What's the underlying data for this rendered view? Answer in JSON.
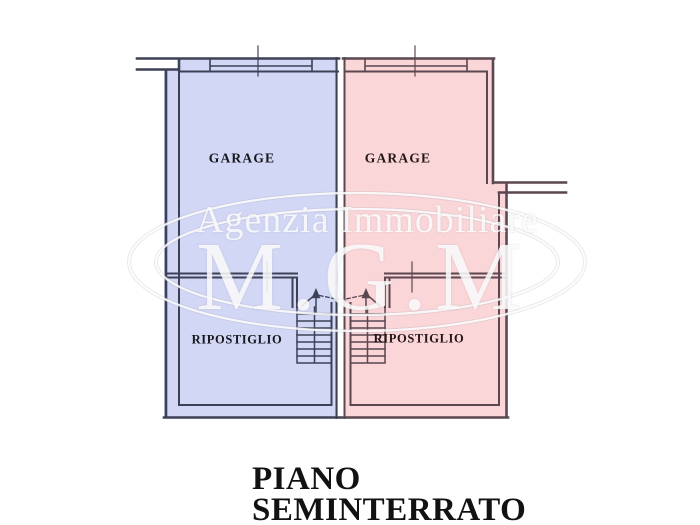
{
  "floor_title": {
    "lines": [
      "PIANO",
      "SEMINTERRATO"
    ]
  },
  "watermark": {
    "agency_line": "Agenzia Immobiliare",
    "logo_text": "M.G.M"
  },
  "units": {
    "left": {
      "garage_label": "GARAGE",
      "storage_label": "RIPOSTIGLIO",
      "fill": "#d2d7f5",
      "stroke": "#3d4156",
      "label_color": "#17171c"
    },
    "right": {
      "garage_label": "GARAGE",
      "storage_label": "RIPOSTIGLIO",
      "fill": "#fad6d8",
      "stroke": "#5a4750",
      "label_color": "#241519"
    }
  }
}
